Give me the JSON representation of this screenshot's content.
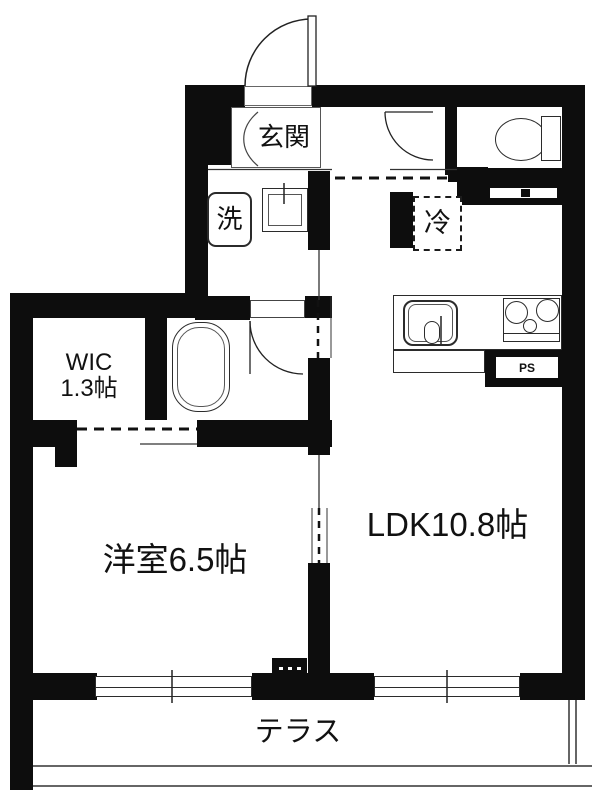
{
  "plan": {
    "type": "apartment-floor-plan",
    "rooms": {
      "genkan": {
        "label": "玄関"
      },
      "washroom": {
        "washer_label": "洗"
      },
      "kitchen": {
        "fridge_label": "冷",
        "ps_label": "PS"
      },
      "wic": {
        "label": "WIC",
        "size": "1.3帖"
      },
      "western_room": {
        "label": "洋室6.5帖"
      },
      "ldk": {
        "label": "LDK10.8帖"
      },
      "terrace": {
        "label": "テラス"
      }
    },
    "colors": {
      "wall": "#0d0d0d",
      "background": "#ffffff",
      "line": "#2b2b2b"
    }
  }
}
